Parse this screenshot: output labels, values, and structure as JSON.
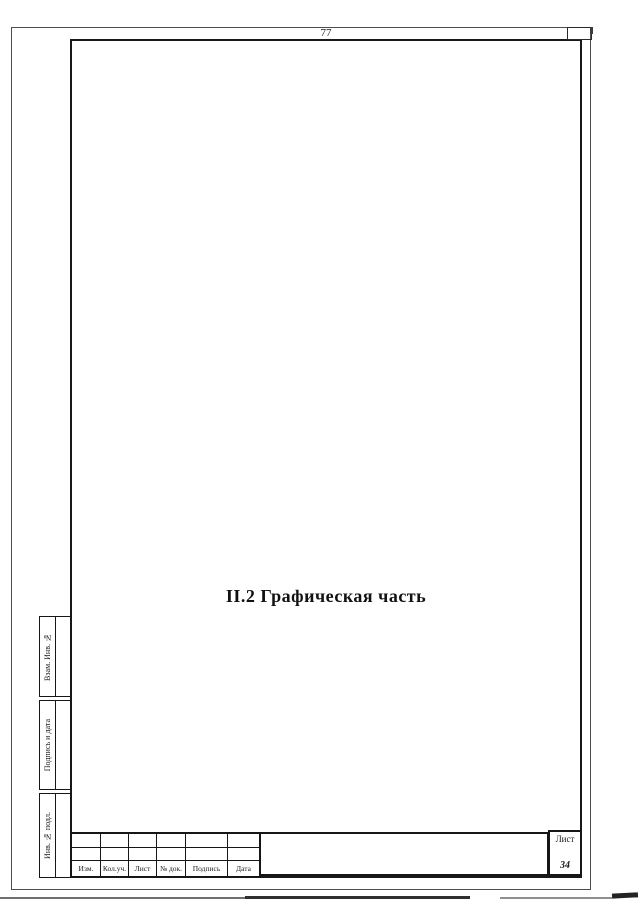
{
  "page": {
    "top_page_number": "77",
    "title": "II.2 Графическая часть"
  },
  "side_column": {
    "labels": [
      "Взам. Инв. №",
      "Подпись и дата",
      "Инв. № подл."
    ]
  },
  "title_block": {
    "columns": [
      "Изм.",
      "Кол.уч.",
      "Лист",
      "№ док.",
      "Подпись",
      "Дата"
    ],
    "sheet_label": "Лист",
    "sheet_number": "34"
  },
  "colors": {
    "paper": "#ffffff",
    "frame_line": "#181818",
    "outer_border_line": "#4d4d4d",
    "text": "#1a1a1a"
  }
}
